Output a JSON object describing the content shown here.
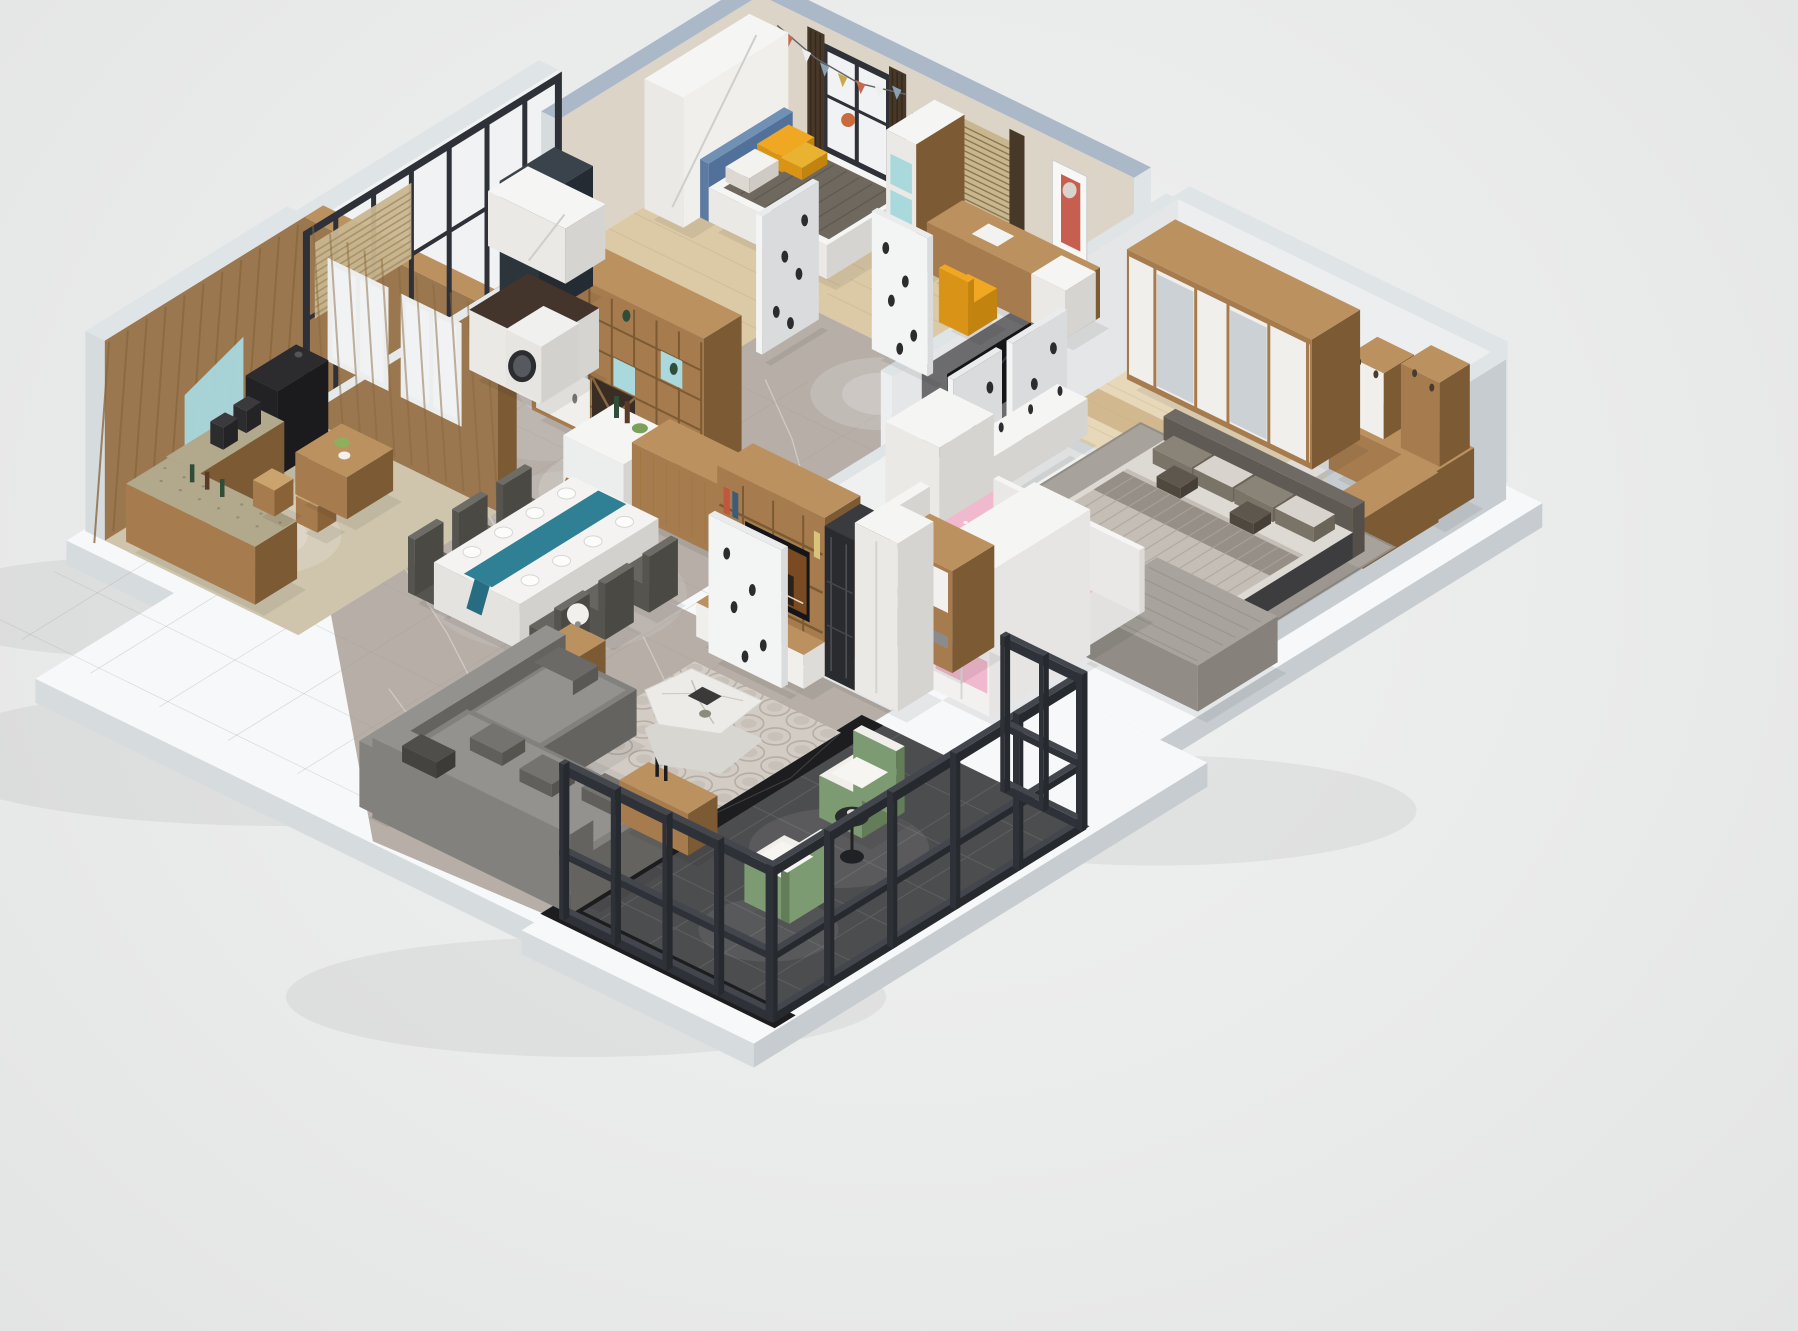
{
  "scene": {
    "type": "isometric-3d-apartment-floor-plan-render",
    "background": "#eceded",
    "render": {
      "width": 1798,
      "height": 1331,
      "projection": "isometric-cutaway"
    },
    "palette": {
      "slabTop": "#f6f8f9",
      "slabSW": "#d6dbde",
      "slabSE": "#c6ccd0",
      "shadow": "#1a1d1f",
      "marble": "#b6aea7",
      "marbleLt": "#cac3bc",
      "marbleVein": "#e0dad3",
      "woodTop": "#bb9160",
      "wood": "#a67c4e",
      "woodDk": "#7c5a33",
      "woodGrain": "#8f6b40",
      "whiteTop": "#f5f5f3",
      "white": "#eae9e6",
      "whiteDk": "#d5d4d1",
      "blue": "#a9d8dd",
      "teal": "#2f7f95",
      "capBlue": "#aab8c8",
      "capWhite": "#dfe4e7",
      "wallIn": "#ddd4c8",
      "wallWhite": "#eceeef",
      "curtain": "#483828",
      "blind": "#c8b68f",
      "glass": "#f0f2f3",
      "frame": "#2e3137",
      "frameLt": "#43474d",
      "yellow": "#f0a722",
      "blanket": "#6e685e",
      "headboardBlue": "#7090b4",
      "pink": "#f0b9ce",
      "pinkLt": "#f8dce6",
      "pinkDk": "#e5a2bd",
      "sofa": "#82817e",
      "sofaDk": "#64635f",
      "sofaLt": "#93928e",
      "marbleTable": "#edebe7",
      "marbleTableSd": "#d8d6d1",
      "green": "#7d9b72",
      "greenDk": "#637d59",
      "balcony": "#4c4d4f",
      "balconyLt": "#5d5e60",
      "blackMarble": "#1d1d1f",
      "masterFloor": "#e7d8ba",
      "masterPlank": "#d5c29e",
      "bedroomFloor": "#dccaa7",
      "bedroomPlank": "#c9b48e",
      "kidsFloor": "#edebe8",
      "teaFloor": "#cfc5ad",
      "rug": "#a7a29b",
      "rugLt": "#d2ccc5",
      "platform": "#3d3d3f",
      "duvet": "#c4beb6",
      "duvetDk": "#968f87",
      "sheet": "#ddd9d3",
      "granite": "#b2a88b",
      "counterDk": "#43352b",
      "tv": "#141518",
      "poster": "#c97e38",
      "door": "#f3f4f4",
      "doorSd": "#d9dbdc",
      "black": "#1a1b1d"
    },
    "rooms": [
      {
        "id": "bedroom-2",
        "name": "second bedroom",
        "items": [
          "yellow-bedding-bed",
          "blue-headboard",
          "white-wardrobe",
          "bunting-garland",
          "black-frame-window",
          "dark-curtains",
          "wood-display-divider-wine-rack"
        ]
      },
      {
        "id": "study-bedroom",
        "name": "study bedroom",
        "items": [
          "wood-desk-with-computer",
          "yellow-chair",
          "rhino-poster",
          "wood-slat-blind",
          "white-shelf-cabinet"
        ]
      },
      {
        "id": "laundry-kitchen",
        "name": "laundry kitchenette",
        "items": [
          "washing-machine",
          "dark-marble-counter",
          "white-wall-cabinet",
          "dark-tall-cabinet"
        ]
      },
      {
        "id": "hallway",
        "name": "hallway",
        "items": [
          "white-speckled-door-a",
          "white-speckled-door-b",
          "white-speckled-door-c",
          "white-speckled-door-d",
          "gray-marble-floor"
        ]
      },
      {
        "id": "master-bedroom",
        "name": "master bedroom",
        "items": [
          "sliding-wardrobe",
          "corner-vanity-desk",
          "cosmetic-shelves",
          "white-pouf",
          "king-bed-gray-bedding",
          "gray-rug",
          "wall-tv-panel",
          "white-tv-console",
          "white-wardrobe",
          "gray-daybed-bench"
        ]
      },
      {
        "id": "kids-room",
        "name": "kids room",
        "items": [
          "pink-hello-kitty-bed",
          "pink-white-wardrobe",
          "pink-desk",
          "white-shelf",
          "entry-shoe-cabinet",
          "white-entry-door"
        ]
      },
      {
        "id": "living-room",
        "name": "living room",
        "items": [
          "l-shaped-gray-sofa",
          "white-marble-coffee-table",
          "wood-side-table-lamp",
          "circle-pattern-rug",
          "tv-media-wall",
          "black-display-cabinet",
          "white-tall-cabinet",
          "media-drawers",
          "wood-console"
        ]
      },
      {
        "id": "dining-area",
        "name": "dining area",
        "items": [
          "marble-dining-table",
          "teal-table-runner",
          "gray-dining-chairs",
          "white-island-counter",
          "wood-bar-divider"
        ]
      },
      {
        "id": "tea-room",
        "name": "tea room",
        "items": [
          "herringbone-wood-walls",
          "granite-coffee-counter",
          "black-console",
          "wood-tea-table",
          "stools",
          "blue-accent-panel",
          "interior-windows",
          "slat-blinds",
          "window-wall"
        ]
      },
      {
        "id": "balcony",
        "name": "balcony",
        "items": [
          "black-steel-glass-railing",
          "dark-tile-floor",
          "black-marble-border",
          "green-armchair-1",
          "green-armchair-2",
          "black-round-table"
        ]
      }
    ]
  }
}
